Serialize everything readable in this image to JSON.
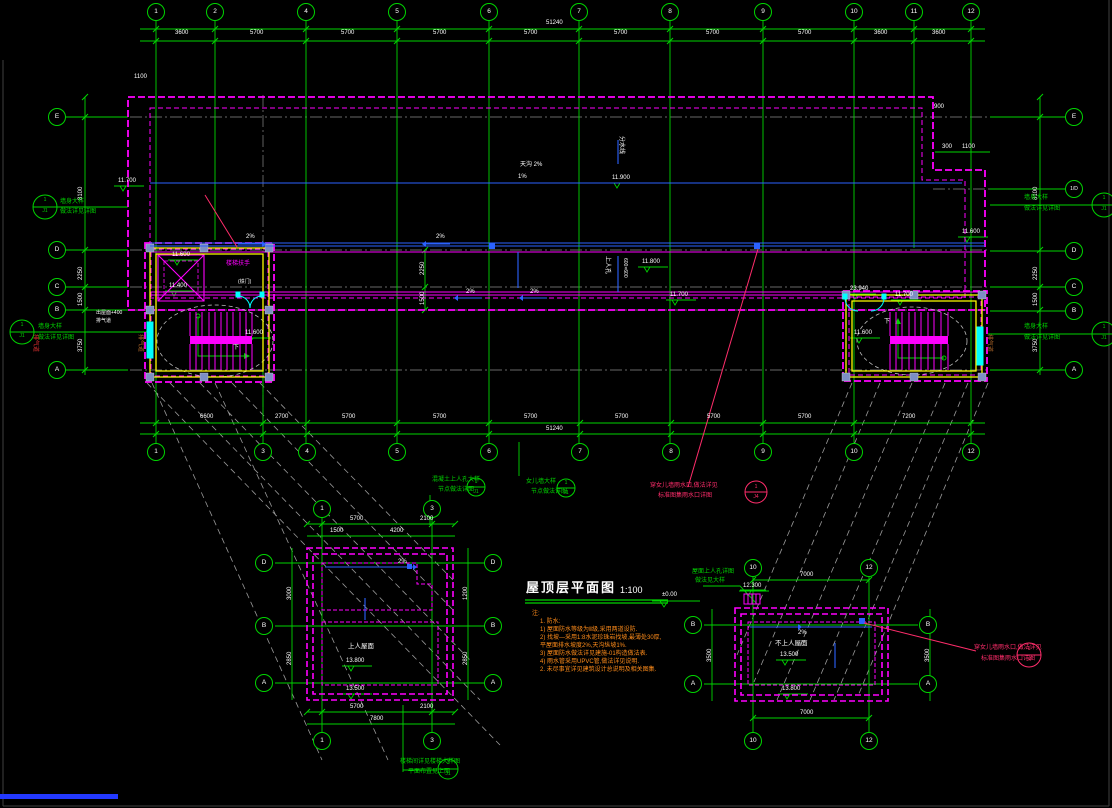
{
  "sheet": {
    "title": "屋顶层平面图",
    "scale": "1:100"
  },
  "axes": {
    "top": [
      "1",
      "2",
      "4",
      "5",
      "6",
      "7",
      "8",
      "9",
      "10",
      "11",
      "12"
    ],
    "bottom": [
      "1",
      "3",
      "4",
      "5",
      "6",
      "7",
      "8",
      "9",
      "10",
      "12"
    ],
    "left": [
      "E",
      "D",
      "C",
      "B",
      "A"
    ],
    "right": [
      "E",
      "1/D",
      "D",
      "C",
      "B",
      "A"
    ],
    "d1_top": [
      "1",
      "3"
    ],
    "d1_bottom": [
      "1",
      "3"
    ],
    "d1_left": [
      "D",
      "B",
      "A"
    ],
    "d1_right": [
      "D",
      "B",
      "A"
    ],
    "d2_top": [
      "10",
      "12"
    ],
    "d2_bottom": [
      "10",
      "12"
    ],
    "d2_left": [
      "B",
      "A"
    ],
    "d2_right": [
      "B",
      "A"
    ]
  },
  "dims": {
    "top": [
      "3600",
      "5700",
      "5700",
      "5700",
      "5700",
      "5700",
      "5700",
      "5700",
      "3600",
      "3600"
    ],
    "top_total": "51240",
    "bottom": [
      "6600",
      "2700",
      "5700",
      "5700",
      "5700",
      "5700",
      "5700",
      "5700",
      "7200"
    ],
    "bottom_total": "51240",
    "left_chain": [
      "8100",
      "2250",
      "1500",
      "3750"
    ],
    "right_chain": [
      "8100",
      "2250",
      "1500",
      "3750"
    ],
    "d1_top": [
      "5700",
      "2100"
    ],
    "d1_top2": [
      "1500",
      "4200"
    ],
    "d1_bottom": [
      "5700",
      "2100"
    ],
    "d1_total": "7800",
    "d1_left": [
      "3000",
      "2850"
    ],
    "d1_right": [
      "1200",
      "2850"
    ],
    "d2_top": "7000",
    "d2_bottom": "7000",
    "d2_left": "3500",
    "d2_right": "3500",
    "step": [
      "300",
      "1100",
      "900"
    ],
    "corr": [
      "2250",
      "1500"
    ],
    "misc_topleft": "1100"
  },
  "levels": {
    "e1": "11.700",
    "e2": "11.900",
    "e3": "11.800",
    "e4": "11.700",
    "e5": "11.700",
    "e6": "11.600",
    "e7": "11.400",
    "e8": "11.600",
    "e9": "11.600",
    "e10": "13.800",
    "e11": "13.500",
    "e12": "13.500",
    "e13": "13.800",
    "e14": "12.300",
    "e15": "23.940",
    "e16": "11.600",
    "datum": "±0.00"
  },
  "labels": {
    "gutter": "天沟 2%",
    "ridge": "分水线",
    "access_hatch": "上人孔",
    "hatch_size": "600×600",
    "slope2": "2%",
    "slope1": "1%",
    "down": "下",
    "vent": "排气道",
    "roof_door": "出屋面+400",
    "handrail": "楼梯扶手",
    "gate": "(铁门)",
    "walkable": "上人屋面",
    "nonwalkable": "不上人屋面"
  },
  "annotations": {
    "red": {
      "line1": "穿女儿墙雨水口,做法详见",
      "line2": "标准图集雨水口详图",
      "ref_top": "1",
      "ref_bot": "J4"
    },
    "green_a": {
      "line1": "混凝土上人孔大样",
      "line2": "节点做法详图",
      "ref_top": "1",
      "ref_bot": "J1"
    },
    "green_b": {
      "line1": "女儿墙大样",
      "line2": "节点做法详图",
      "ref_top": "1",
      "ref_bot": "J1"
    },
    "green_c": {
      "line1": "楼梯间详见楼梯大样图",
      "line2": "平面布置见上图",
      "ref_top": "1",
      "ref_bot": "J1"
    },
    "green_d": {
      "line1": "屋面上人孔详图",
      "line2": "做法见大样"
    },
    "side": {
      "line1": "墙身大样",
      "line2": "做法详见详图",
      "ref_top": "1",
      "ref_bot": "J1"
    }
  },
  "notes": {
    "heading": "注:",
    "lines": [
      "1. 防水:",
      "1) 屋面防水等级为Ⅱ级,采用两道设防.",
      "2) 找坡—采用1:8水泥珍珠岩找坡,最薄处30厚,",
      "      平屋面排水坡度2%,天沟纵坡1%.",
      "3) 屋面防水做法详见建施-01构造做法表.",
      "4) 雨水管采用UPVC管,做法详见说明.",
      "2. 未尽事宜详见建筑设计总说明及相关图集."
    ]
  }
}
